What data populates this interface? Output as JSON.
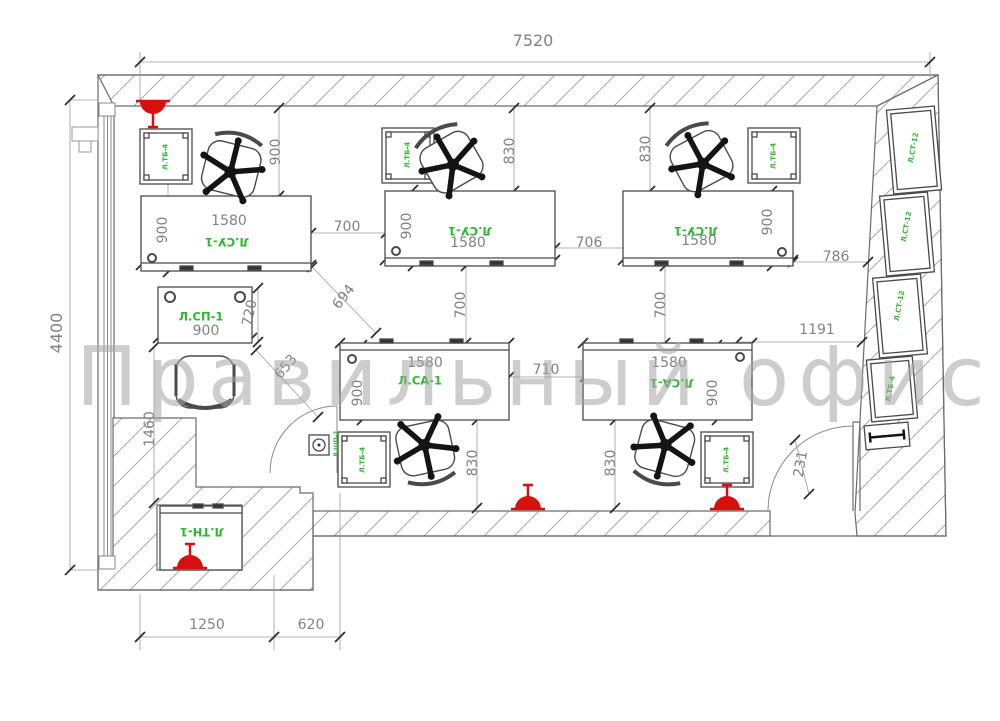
{
  "watermark": "Правильный офис",
  "colors": {
    "furniture_label_green": "#2db82d",
    "dimension_gray": "#828282",
    "sprinkler_red": "#d60f0f",
    "hatch_gray": "#a9a9a9"
  },
  "dimensions": [
    {
      "id": "overall-width",
      "text": "7520"
    },
    {
      "id": "overall-height",
      "text": "4400"
    },
    {
      "id": "desk1-depth",
      "text": "900"
    },
    {
      "id": "desk1-width",
      "text": "1580"
    },
    {
      "id": "desk1-side",
      "text": "900"
    },
    {
      "id": "gap-desk1-desk2",
      "text": "700"
    },
    {
      "id": "diag-a",
      "text": "694"
    },
    {
      "id": "desk2-depth",
      "text": "900"
    },
    {
      "id": "desk2-width",
      "text": "1580"
    },
    {
      "id": "desk2-side",
      "text": "830"
    },
    {
      "id": "gap-desk2-desk3",
      "text": "706"
    },
    {
      "id": "gap-rows-left",
      "text": "700"
    },
    {
      "id": "desk3-side",
      "text": "830"
    },
    {
      "id": "desk3-width",
      "text": "1580"
    },
    {
      "id": "desk3-depth",
      "text": "900"
    },
    {
      "id": "gap-desk3-wall",
      "text": "786"
    },
    {
      "id": "gap-rows-right",
      "text": "700"
    },
    {
      "id": "gap-to-cabinets",
      "text": "1191"
    },
    {
      "id": "table-sp1-depth",
      "text": "720"
    },
    {
      "id": "table-sp1-width",
      "text": "900"
    },
    {
      "id": "diag-b",
      "text": "653"
    },
    {
      "id": "left-clearance",
      "text": "1460"
    },
    {
      "id": "desk4-width",
      "text": "1580"
    },
    {
      "id": "desk4-depth",
      "text": "900"
    },
    {
      "id": "gap-desk4-desk5",
      "text": "710"
    },
    {
      "id": "desk4-side",
      "text": "830"
    },
    {
      "id": "desk5-width",
      "text": "1580"
    },
    {
      "id": "desk5-depth",
      "text": "900"
    },
    {
      "id": "desk5-side",
      "text": "830"
    },
    {
      "id": "door-stub",
      "text": "231"
    },
    {
      "id": "niche-width",
      "text": "1250"
    },
    {
      "id": "step-width",
      "text": "620"
    }
  ],
  "furniture_labels": [
    {
      "id": "desk-top-left",
      "text": "Л.СУ-1"
    },
    {
      "id": "desk-top-middle",
      "text": "Л.СУ-1"
    },
    {
      "id": "desk-top-right",
      "text": "Л.СУ-1"
    },
    {
      "id": "desk-bottom-left",
      "text": "Л.СА-1"
    },
    {
      "id": "desk-bottom-right",
      "text": "Л.СА-1"
    },
    {
      "id": "meeting-table",
      "text": "Л.СП-1"
    },
    {
      "id": "low-table",
      "text": "Л.ТН-1"
    },
    {
      "id": "pedestal-1",
      "text": "Л.ТБ-4"
    },
    {
      "id": "pedestal-2",
      "text": "Л.ТБ-4"
    },
    {
      "id": "pedestal-3",
      "text": "Л.ТБ-4"
    },
    {
      "id": "pedestal-4",
      "text": "Л.ТБ-4"
    },
    {
      "id": "pedestal-5",
      "text": "Л.ТБ-4"
    },
    {
      "id": "tall-cabinet-1",
      "text": "Л.СТ-12"
    },
    {
      "id": "tall-cabinet-2",
      "text": "Л.СТ-12"
    },
    {
      "id": "tall-cabinet-3",
      "text": "Л.СТ-12"
    },
    {
      "id": "stack-pedestal",
      "text": "Л.ТБ-4"
    },
    {
      "id": "floor-box",
      "text": "Л.ШП-2"
    }
  ]
}
